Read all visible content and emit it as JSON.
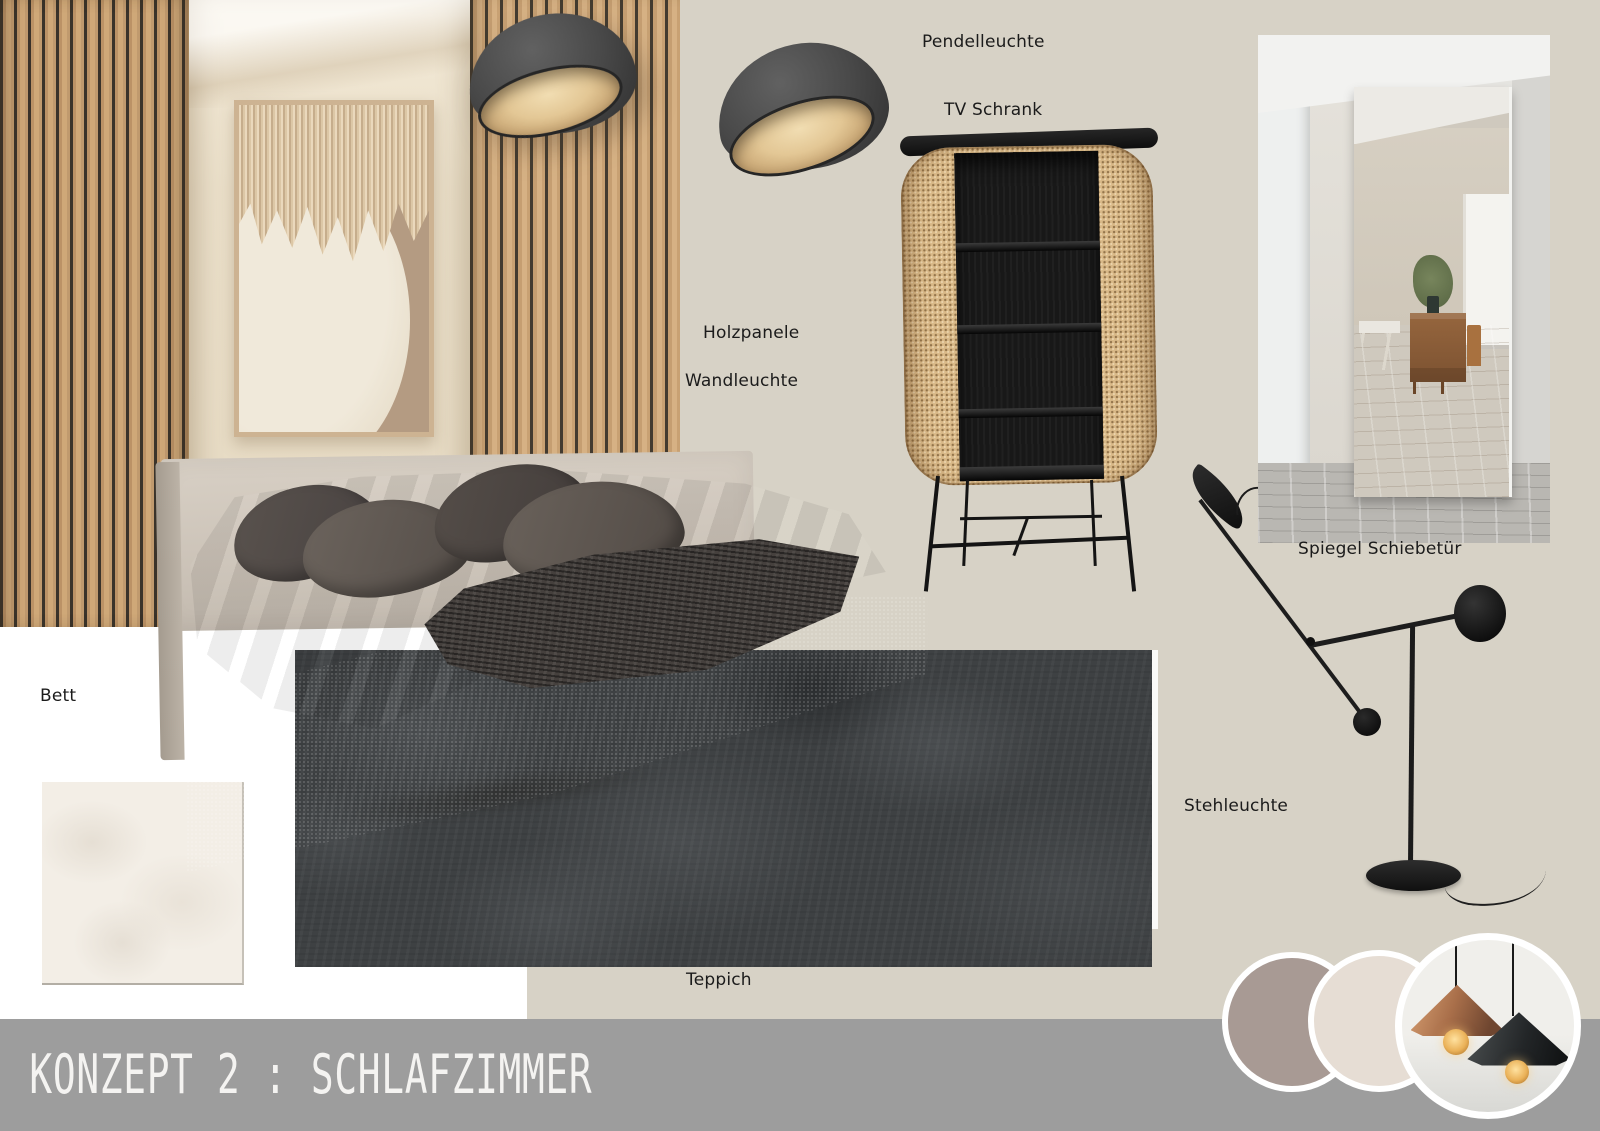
{
  "board": {
    "title": "KONZEPT 2 : SCHLAFZIMMER",
    "labels": {
      "pendant_lamp": "Pendelleuchte",
      "tv_cabinet": "TV Schrank",
      "wood_panels": "Holzpanele",
      "wall_lamp": "Wandleuchte",
      "mirror_sliding_door": "Spiegel Schiebetür",
      "bed": "Bett",
      "floor_lamp": "Stehleuchte",
      "rug": "Teppich"
    },
    "colors": {
      "page_background": "#d7d2c6",
      "title_bar": "#9d9d9d",
      "title_text": "#f4f3f1",
      "label_text": "#1b1b1b",
      "white_area": "#ffffff",
      "color_circle_1": "#a89a94",
      "color_circle_2": "#e6ddd4",
      "fabric_swatch": "#f3eee6",
      "carpet": "#3e4143",
      "wood_slats": "#c49d72",
      "cane_weave": "#d9b988",
      "cabinet_black": "#181818",
      "bed_boucle": "#cfc6bb",
      "bedding": "#5f5853",
      "lamp_shell": "#4a4a4a",
      "lamp_wood_interior": "#e3c795",
      "pendant_copper": "#a96f4a"
    }
  }
}
